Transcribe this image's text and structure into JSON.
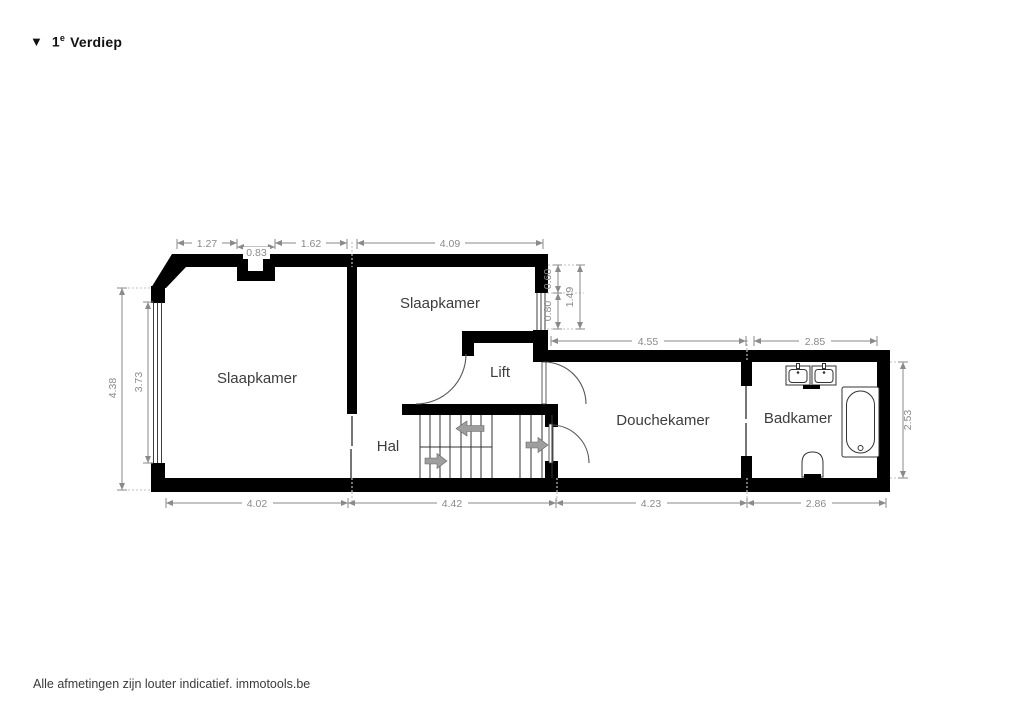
{
  "title": {
    "marker_icon": "▼",
    "floor": "1",
    "floor_sup": "e",
    "name": "Verdiep"
  },
  "rooms": {
    "bedroom_left": "Slaapkamer",
    "bedroom_middle": "Slaapkamer",
    "lift": "Lift",
    "hall": "Hal",
    "shower_room": "Douchekamer",
    "bathroom": "Badkamer"
  },
  "dimensions": {
    "top_left_width": "1.27",
    "chimney_width": "0.83",
    "top_mid_width": "1.62",
    "bedroom_middle_width": "4.09",
    "right_upper_offset": "0.60",
    "right_window_width": "0.80",
    "right_upper_total": "1.49",
    "left_total_height": "4.38",
    "left_window_height": "3.73",
    "shower_room_width": "4.55",
    "bathroom_width": "2.85",
    "bathroom_height": "2.53",
    "bottom_bedroom_width": "4.02",
    "bottom_hall_width": "4.42",
    "bottom_shower_width": "4.23",
    "bottom_bathroom_width": "2.86"
  },
  "footer": {
    "text": "Alle afmetingen zijn louter indicatief. immotools.be"
  },
  "colors": {
    "wall": "#000000",
    "dimension": "#8a8a8a",
    "label": "#3d3d3d",
    "arrow_fill": "#9e9e9e"
  }
}
